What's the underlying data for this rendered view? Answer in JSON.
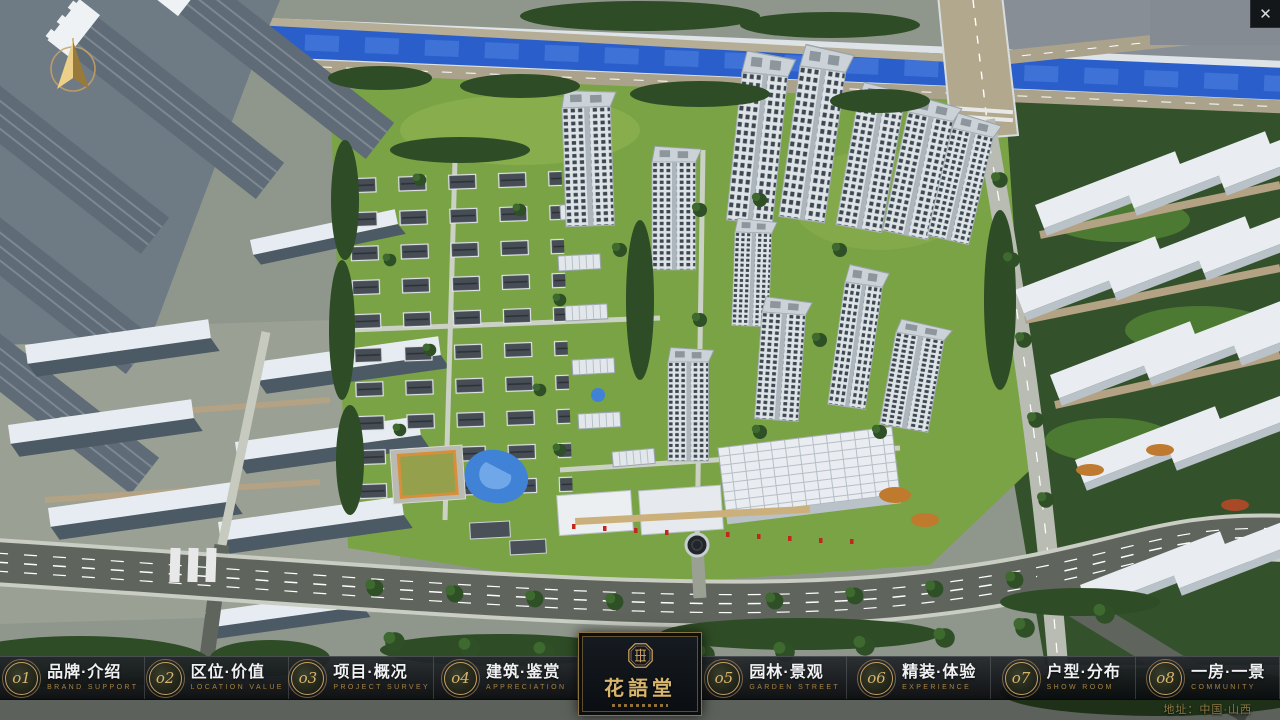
{
  "window": {
    "close_glyph": "✕"
  },
  "nav": {
    "items": [
      {
        "num": "o1",
        "title": "品牌·介绍",
        "subtitle": "BRAND SUPPORT"
      },
      {
        "num": "o2",
        "title": "区位·价值",
        "subtitle": "LOCATION VALUE"
      },
      {
        "num": "o3",
        "title": "项目·概况",
        "subtitle": "PROJECT SURVEY"
      },
      {
        "num": "o4",
        "title": "建筑·鉴赏",
        "subtitle": "APPRECIATION"
      },
      {
        "num": "o5",
        "title": "园林·景观",
        "subtitle": "GARDEN STREET"
      },
      {
        "num": "o6",
        "title": "精装·体验",
        "subtitle": "EXPERIENCE"
      },
      {
        "num": "o7",
        "title": "户型·分布",
        "subtitle": "SHOW ROOM"
      },
      {
        "num": "o8",
        "title": "一房·一景",
        "subtitle": "COMMUNITY"
      }
    ]
  },
  "logo": {
    "name": "花語堂"
  },
  "footer": {
    "address": "地址：中国·山西"
  },
  "colors": {
    "accent_gold": "#c9a063",
    "nav_bar_bg": "#0b0f13",
    "river_blue": "#2a5ecb",
    "grass_green": "#79a344"
  }
}
